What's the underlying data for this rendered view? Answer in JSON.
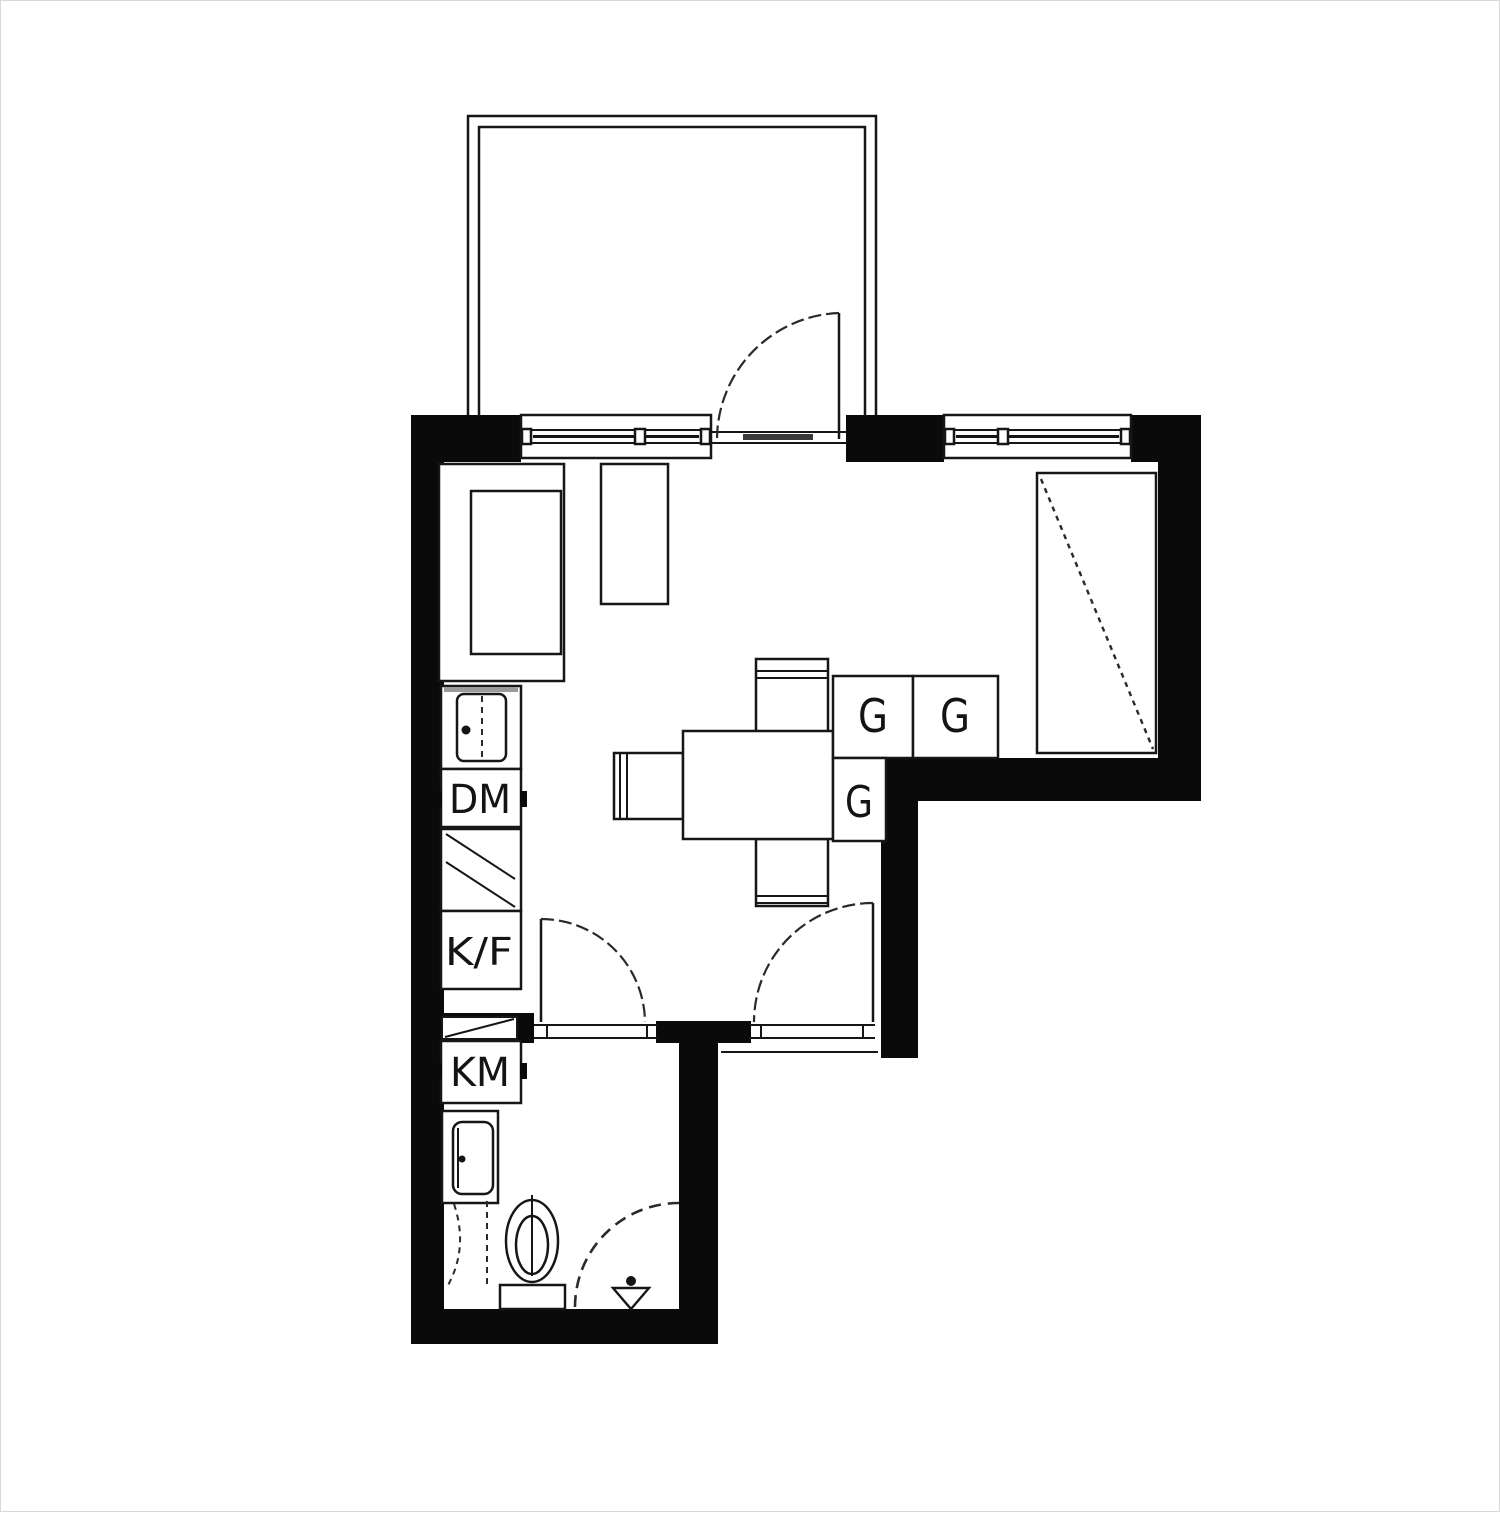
{
  "plan": {
    "kind": "studio-apartment-floor-plan",
    "colors": {
      "wall": "#0a0a0a",
      "line": "#161616",
      "background": "#ffffff"
    },
    "labels": {
      "wardrobe_top_left": "G",
      "wardrobe_top_right": "G",
      "wardrobe_lower": "G",
      "dishwasher": "DM",
      "fridge_freezer": "K/F",
      "washing_machine": "KM"
    }
  }
}
